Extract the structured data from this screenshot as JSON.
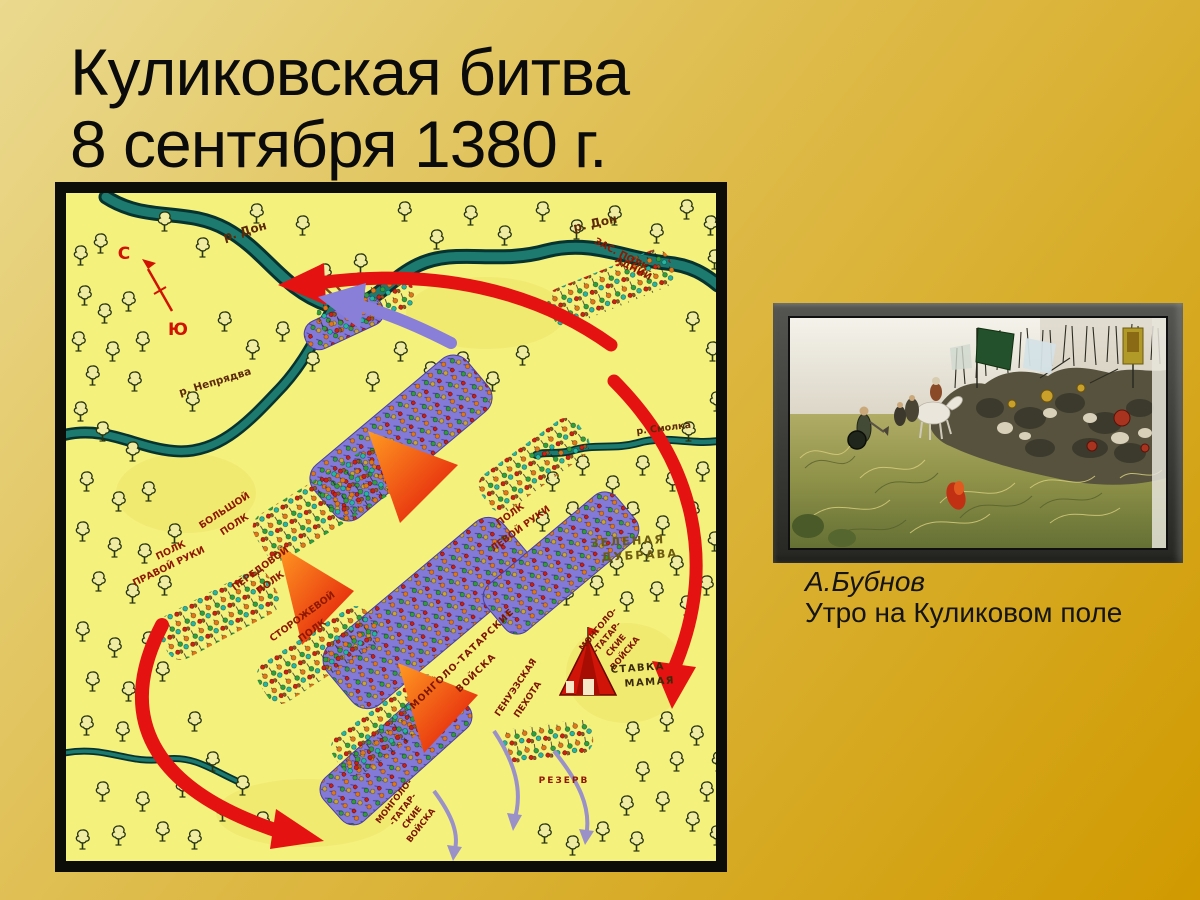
{
  "slide": {
    "title_lines": [
      "Куликовская битва",
      "8 сентября 1380 г."
    ],
    "background_colors": [
      "#ead98e",
      "#d09a00"
    ]
  },
  "battle_map": {
    "compass": {
      "north": "С",
      "south": "Ю"
    },
    "rivers": {
      "don": "р. Дон",
      "nepryadva": "р. Непрядва",
      "smolka": "р. Смолка"
    },
    "places": {
      "green_grove": [
        "ЗЕЛЕНАЯ",
        "ДУБРАВА"
      ],
      "hq": [
        "СТАВКА",
        "МАМАЯ"
      ]
    },
    "russian_regiments": {
      "right_hand": [
        "ПОЛК",
        "ПРАВОЙ РУКИ"
      ],
      "big": [
        "БОЛЬШОЙ",
        "ПОЛК"
      ],
      "advance": [
        "ПЕРЕДОВОЙ",
        "ПОЛК"
      ],
      "guard": [
        "СТОРОЖЕВОЙ",
        "ПОЛК"
      ],
      "left_hand": [
        "ПОЛК",
        "ЛЕВОЙ РУКИ"
      ],
      "ambush": [
        "ЗАС. ПОЛК",
        "АДНИЙ"
      ]
    },
    "mongol_forces": {
      "main": [
        "МОНГОЛО-ТАТАРСКИЕ",
        "ВОЙСКА"
      ],
      "genoese": [
        "ГЕНУЭЗСКАЯ",
        "ПЕХОТА"
      ],
      "northeast": [
        "МОНГОЛО-",
        "-ТАТАР-",
        "СКИЕ",
        "ВОЙСКА"
      ],
      "southwest": [
        "МОНГОЛО-",
        "-ТАТАР-",
        "СКИЕ",
        "ВОЙСКА"
      ],
      "reserve": "РЕЗЕРВ"
    },
    "colors": {
      "map_background": "#f5f17d",
      "river": "#1d7a6e",
      "attack_arrow": "#e51212",
      "retreat_arrow": "#9a91c9",
      "mongol_troops": "#8379d6",
      "label_red": "#8e1800"
    }
  },
  "painting": {
    "author": "А.Бубнов",
    "title": "Утро на Куликовом поле"
  }
}
